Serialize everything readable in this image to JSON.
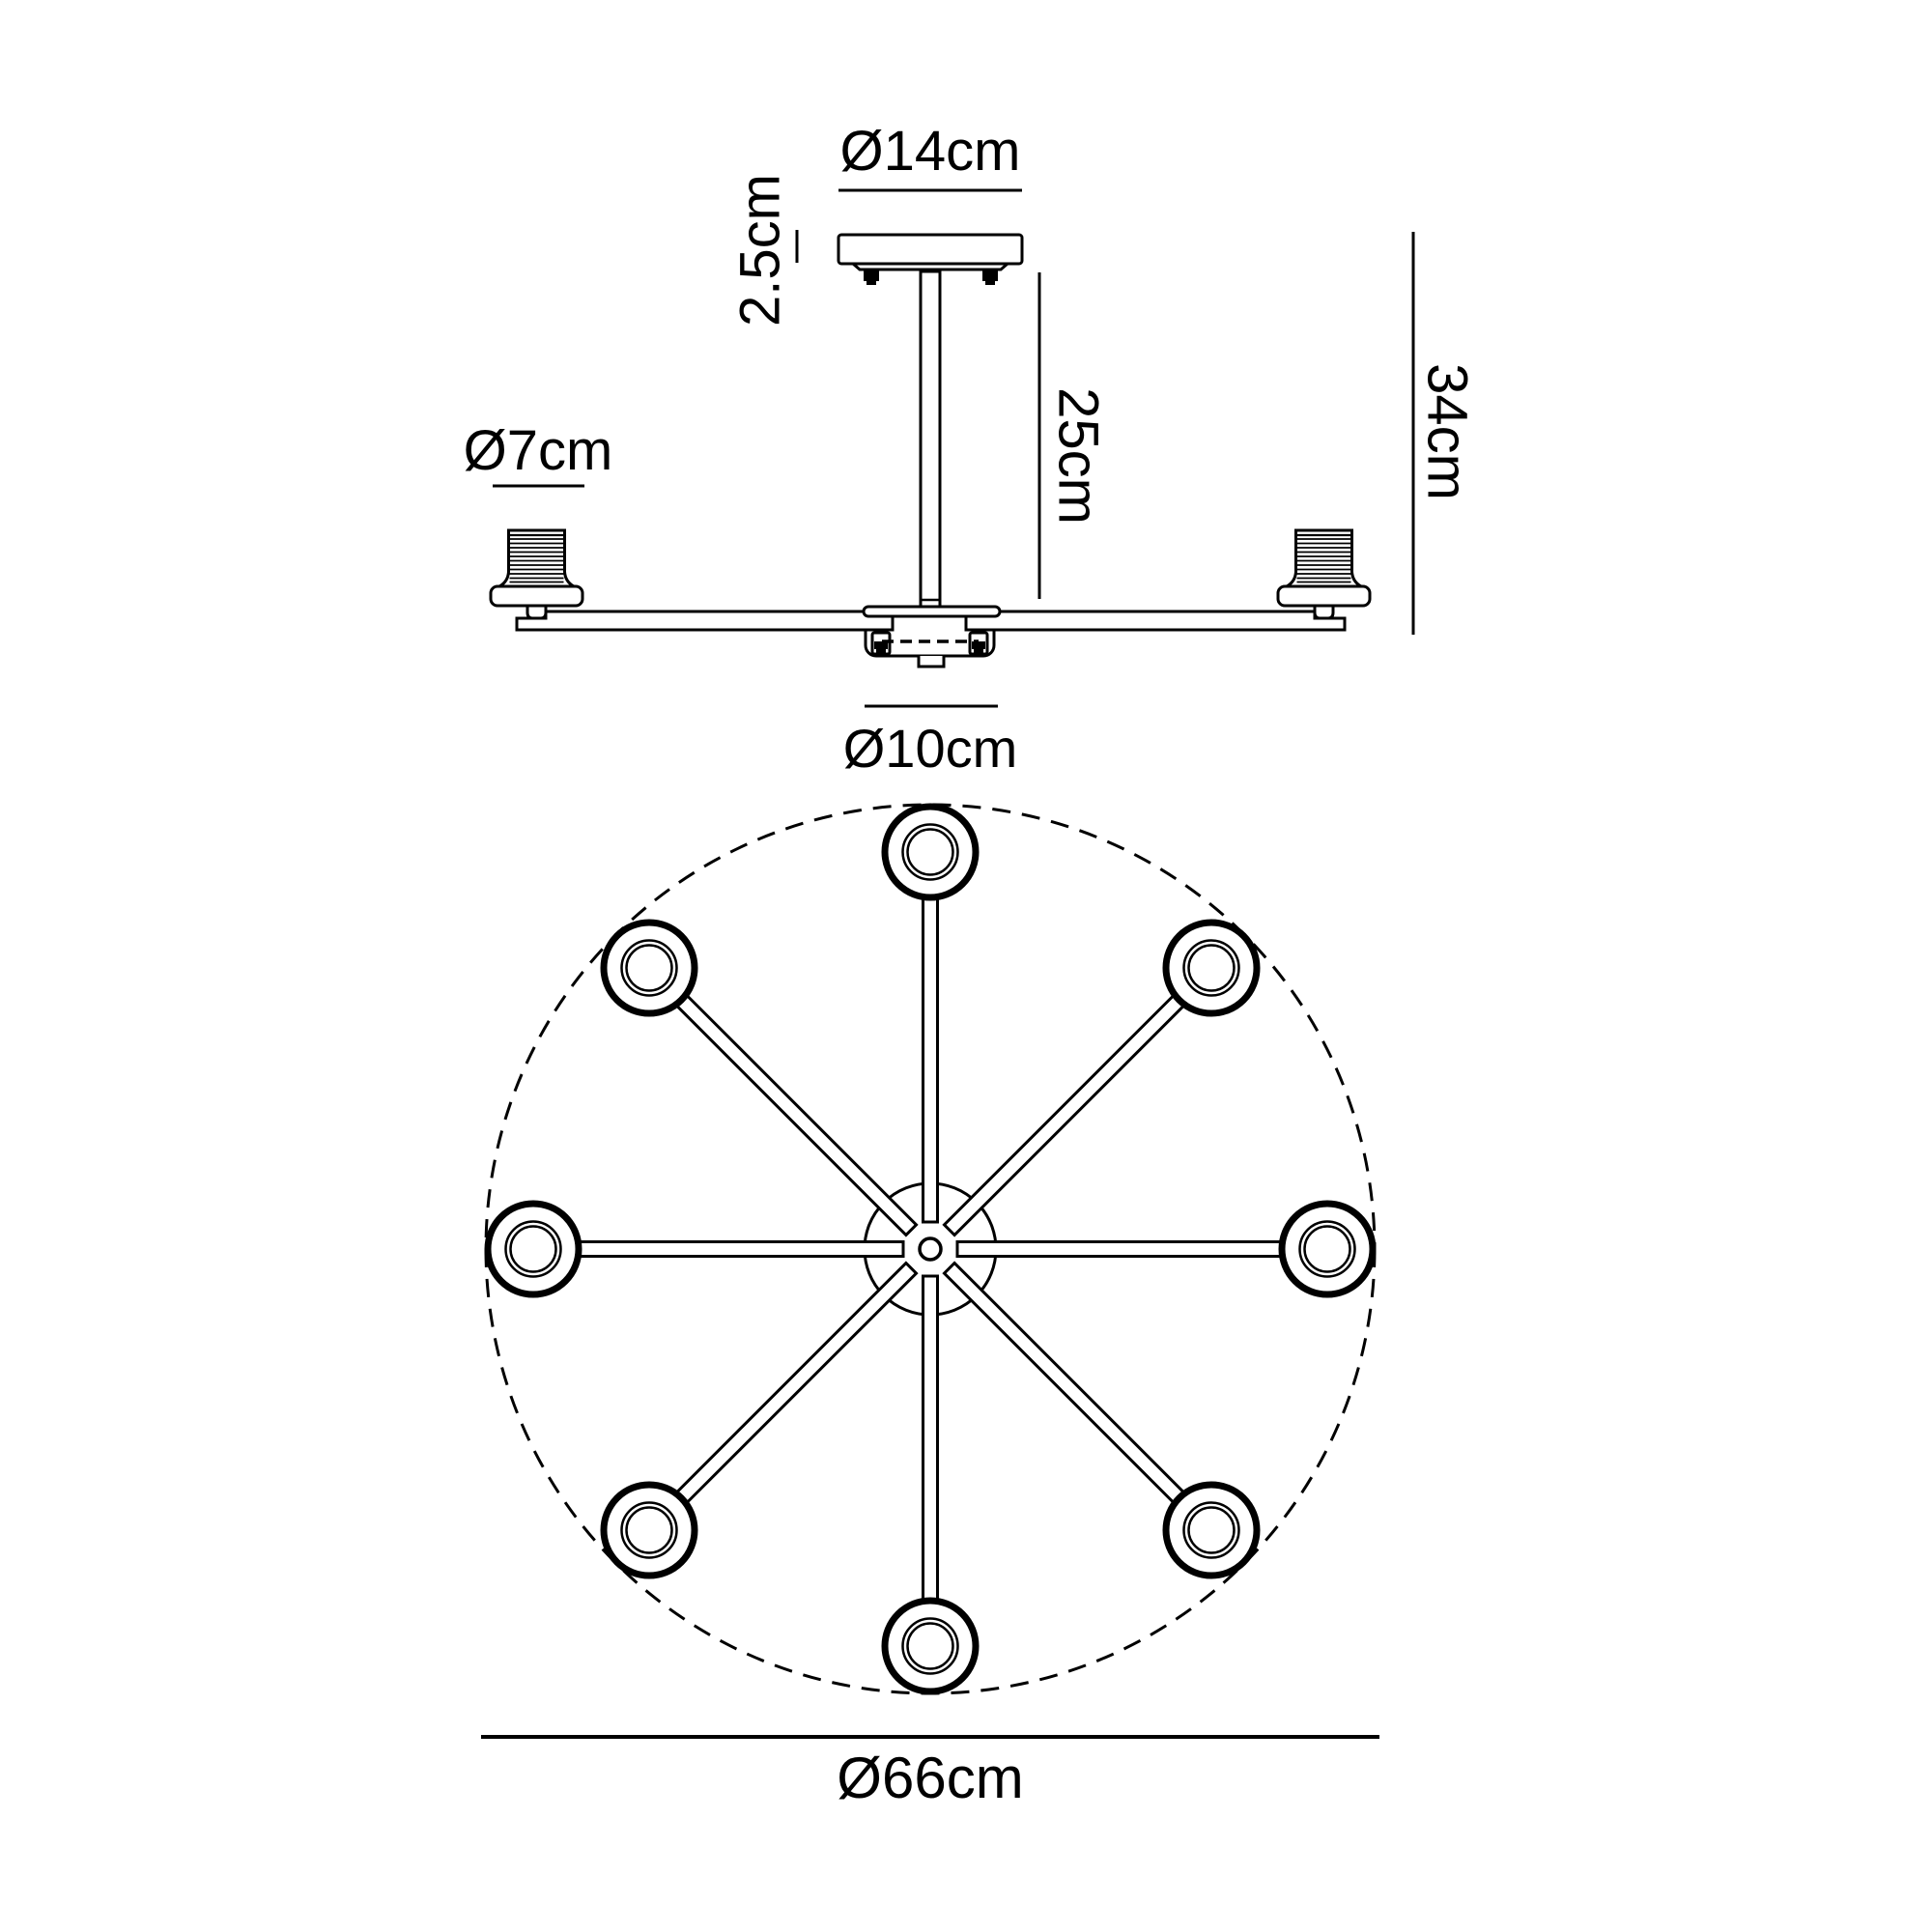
{
  "labels": {
    "canopy_diameter": "Ø14cm",
    "canopy_height": "2.5cm",
    "rod_drop": "25cm",
    "fixture_height": "34cm",
    "lampholder_diameter": "Ø7cm",
    "hub_diameter": "Ø10cm",
    "spread_diameter": "Ø66cm"
  },
  "plan": {
    "arm_count": 8,
    "lampholder_count": 8
  },
  "colors": {
    "line": "#000000",
    "background": "#ffffff"
  }
}
